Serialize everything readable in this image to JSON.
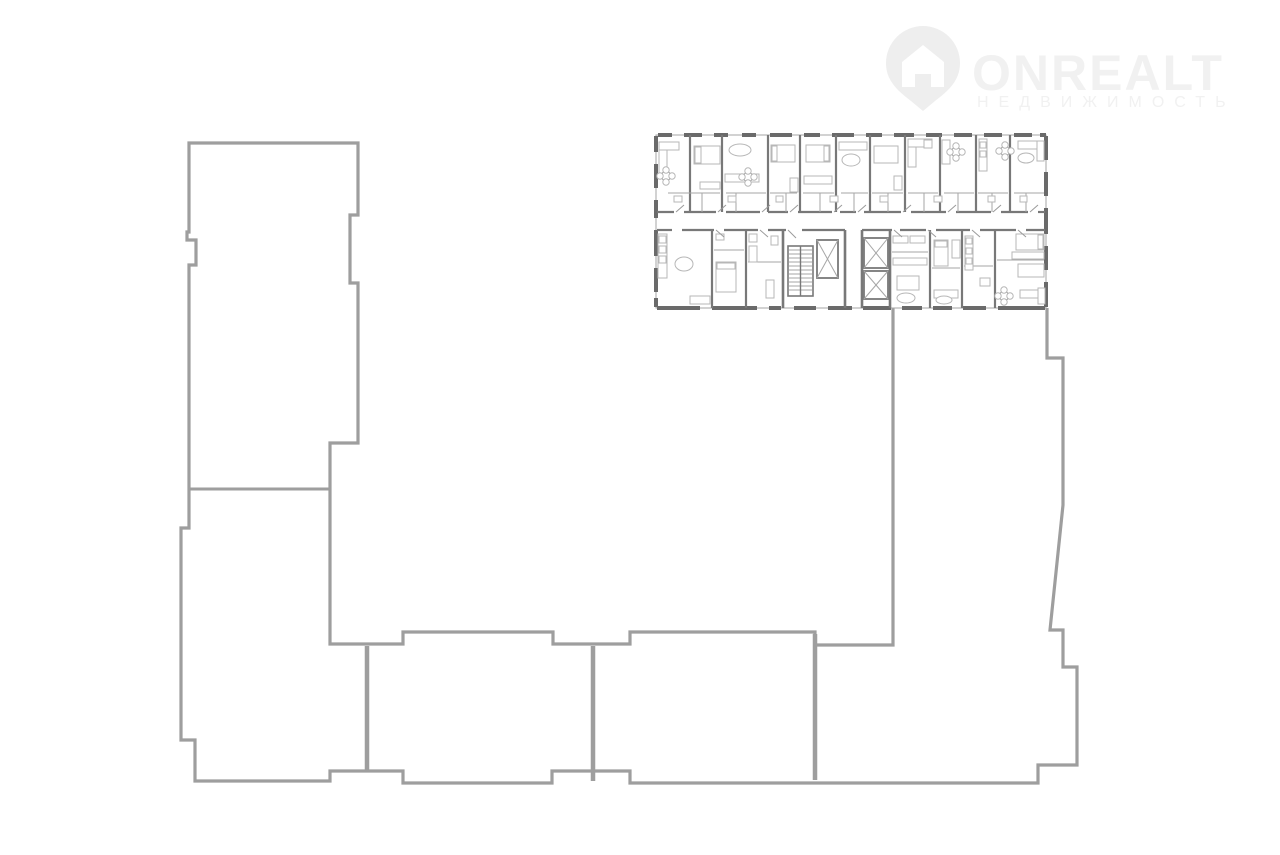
{
  "canvas": {
    "width": 1280,
    "height": 855,
    "background": "#ffffff"
  },
  "logo": {
    "brand": "ONREALT",
    "subtitle": "НЕДВИЖИМОСТЬ",
    "text_color": "#f1f1f1",
    "icon_color": "#eeeeee",
    "pin_path": "M 923,26 a 37,37 0 0 1 37,37 c 0,18 -12,28 -25,38 l -12,10 l -12,-10 c -13,-10 -25,-20 -25,-38 a 37,37 0 0 1 37,-37 z",
    "house_path": "M 923,45 l 21,17 v 25 h -13 v -13 h -16 v 13 h -13 v -25 z"
  },
  "building_outline": {
    "stroke": "#9e9e9e",
    "stroke_width": 3.2,
    "path": "M 893,308 L 893,645 L 815,645 L 815,632 L 630,632 L 630,644 L 553,644 L 553,632 L 403,632 L 403,644 L 330,644 L 330,443 L 358,443 L 358,283 L 350,283 L 350,215 L 358,215 L 358,143 L 189,143 L 189,232 L 187,232 L 187,240 L 196,240 L 196,265 L 189,265 L 189,528 L 181,528 L 181,740 L 195,740 L 195,781 L 330,781 L 330,771 L 403,771 L 403,783 L 552,783 L 552,771 L 630,771 L 630,783 L 1038,783 L 1038,765 L 1077,765 L 1077,667 L 1063,667 L 1063,630 L 1050,630 L 1063,505 L 1063,358 L 1047,358 L 1047,308",
    "dividers": [
      [
        367,
        646,
        367,
        770
      ],
      [
        593,
        646,
        593,
        781
      ],
      [
        815,
        634,
        815,
        780
      ]
    ],
    "divider_width": 4.5,
    "interior_lines": [
      [
        189,
        489,
        330,
        489
      ]
    ],
    "interior_width": 3
  },
  "floorplan": {
    "frame": {
      "x": 656,
      "y": 135,
      "w": 390,
      "h": 173
    },
    "colors": {
      "wall": "#787878",
      "pier": "#6a6a6a",
      "thin": "#a6a6a6",
      "furniture": "#b7b7b7",
      "door": "#9a9a9a"
    },
    "outer_piers_top": [
      [
        658,
        672
      ],
      [
        684,
        702
      ],
      [
        714,
        728
      ],
      [
        742,
        756
      ],
      [
        770,
        792
      ],
      [
        804,
        820
      ],
      [
        832,
        854
      ],
      [
        866,
        882
      ],
      [
        894,
        914
      ],
      [
        926,
        942
      ],
      [
        954,
        972
      ],
      [
        984,
        1002
      ],
      [
        1014,
        1032
      ],
      [
        1040,
        1046
      ]
    ],
    "outer_piers_bottom": [
      [
        657,
        700
      ],
      [
        712,
        757
      ],
      [
        769,
        781
      ],
      [
        794,
        816
      ],
      [
        828,
        852
      ],
      [
        863,
        891
      ],
      [
        902,
        922
      ],
      [
        933,
        952
      ],
      [
        963,
        986
      ],
      [
        998,
        1045
      ]
    ],
    "outer_piers_left": [
      [
        136,
        152
      ],
      [
        164,
        188
      ],
      [
        200,
        218
      ],
      [
        230,
        256
      ],
      [
        268,
        292
      ],
      [
        298,
        307
      ]
    ],
    "outer_piers_right": [
      [
        136,
        160
      ],
      [
        172,
        196
      ],
      [
        208,
        234
      ],
      [
        246,
        270
      ],
      [
        282,
        307
      ]
    ],
    "corridor_top_y": 212,
    "corridor_bottom_y": 230,
    "corridor_top_segments": [
      [
        657,
        674
      ],
      [
        684,
        716
      ],
      [
        726,
        760
      ],
      [
        768,
        788
      ],
      [
        798,
        832
      ],
      [
        840,
        856
      ],
      [
        864,
        901
      ],
      [
        911,
        946
      ],
      [
        956,
        991
      ],
      [
        1001,
        1028
      ],
      [
        1038,
        1045
      ]
    ],
    "corridor_bottom_segments": [
      [
        657,
        672
      ],
      [
        682,
        714
      ],
      [
        724,
        758
      ],
      [
        768,
        786
      ],
      [
        802,
        845
      ],
      [
        862,
        892
      ],
      [
        900,
        926
      ],
      [
        936,
        970
      ],
      [
        980,
        1016
      ],
      [
        1026,
        1045
      ]
    ],
    "vwalls_upper": [
      690,
      722,
      768,
      800,
      836,
      870,
      905,
      940,
      976,
      1010
    ],
    "vwalls_lower": [
      712,
      746,
      930,
      962,
      995
    ],
    "core_vwalls": [
      783,
      845,
      862,
      890
    ],
    "thin_walls": [
      [
        668,
        193,
        720,
        193
      ],
      [
        726,
        193,
        766,
        193
      ],
      [
        770,
        193,
        797,
        193
      ],
      [
        803,
        193,
        834,
        193
      ],
      [
        841,
        193,
        868,
        193
      ],
      [
        872,
        193,
        903,
        193
      ],
      [
        908,
        193,
        938,
        193
      ],
      [
        944,
        193,
        974,
        193
      ],
      [
        978,
        193,
        1008,
        193
      ],
      [
        1014,
        193,
        1044,
        193
      ],
      [
        702,
        193,
        702,
        212
      ],
      [
        736,
        193,
        736,
        212
      ],
      [
        786,
        193,
        786,
        212
      ],
      [
        820,
        193,
        820,
        212
      ],
      [
        854,
        193,
        854,
        212
      ],
      [
        888,
        193,
        888,
        212
      ],
      [
        924,
        193,
        924,
        212
      ],
      [
        958,
        193,
        958,
        212
      ],
      [
        992,
        193,
        992,
        212
      ],
      [
        1026,
        193,
        1026,
        212
      ],
      [
        714,
        250,
        744,
        250
      ],
      [
        748,
        262,
        781,
        262
      ],
      [
        892,
        252,
        928,
        252
      ],
      [
        932,
        268,
        960,
        268
      ],
      [
        964,
        266,
        993,
        266
      ],
      [
        997,
        260,
        1044,
        260
      ]
    ],
    "furniture_rects": [
      [
        659,
        142,
        8,
        34
      ],
      [
        659,
        142,
        20,
        8
      ],
      [
        694,
        146,
        26,
        18
      ],
      [
        695,
        147,
        6,
        16
      ],
      [
        700,
        182,
        20,
        7
      ],
      [
        725,
        174,
        34,
        8
      ],
      [
        771,
        145,
        24,
        17
      ],
      [
        772,
        146,
        5,
        15
      ],
      [
        790,
        178,
        8,
        14
      ],
      [
        806,
        145,
        24,
        17
      ],
      [
        824,
        146,
        5,
        15
      ],
      [
        804,
        176,
        28,
        8
      ],
      [
        839,
        142,
        28,
        8
      ],
      [
        874,
        146,
        24,
        17
      ],
      [
        894,
        176,
        8,
        14
      ],
      [
        908,
        139,
        8,
        28
      ],
      [
        908,
        139,
        24,
        8
      ],
      [
        924,
        140,
        8,
        8
      ],
      [
        942,
        140,
        8,
        24
      ],
      [
        979,
        139,
        8,
        32
      ],
      [
        980,
        142,
        6,
        6
      ],
      [
        980,
        151,
        6,
        6
      ],
      [
        1018,
        141,
        26,
        8
      ],
      [
        1037,
        141,
        7,
        20
      ],
      [
        674,
        196,
        8,
        6
      ],
      [
        728,
        196,
        8,
        6
      ],
      [
        776,
        196,
        7,
        6
      ],
      [
        830,
        196,
        8,
        6
      ],
      [
        880,
        196,
        8,
        6
      ],
      [
        934,
        196,
        8,
        6
      ],
      [
        988,
        196,
        7,
        6
      ],
      [
        1020,
        196,
        7,
        6
      ],
      [
        658,
        234,
        9,
        44
      ],
      [
        659,
        236,
        7,
        7
      ],
      [
        659,
        246,
        7,
        7
      ],
      [
        659,
        256,
        7,
        7
      ],
      [
        690,
        296,
        20,
        8
      ],
      [
        716,
        234,
        8,
        6
      ],
      [
        716,
        262,
        20,
        30
      ],
      [
        717,
        263,
        18,
        6
      ],
      [
        749,
        234,
        8,
        8
      ],
      [
        749,
        246,
        8,
        16
      ],
      [
        771,
        236,
        7,
        9
      ],
      [
        766,
        280,
        8,
        18
      ],
      [
        893,
        236,
        15,
        7
      ],
      [
        910,
        236,
        15,
        7
      ],
      [
        893,
        258,
        34,
        7
      ],
      [
        897,
        276,
        22,
        14
      ],
      [
        934,
        240,
        14,
        26
      ],
      [
        935,
        241,
        12,
        6
      ],
      [
        952,
        240,
        8,
        18
      ],
      [
        934,
        290,
        24,
        8
      ],
      [
        965,
        236,
        8,
        34
      ],
      [
        966,
        238,
        6,
        6
      ],
      [
        966,
        248,
        6,
        6
      ],
      [
        966,
        258,
        6,
        6
      ],
      [
        980,
        278,
        10,
        8
      ],
      [
        1016,
        234,
        28,
        16
      ],
      [
        1038,
        235,
        5,
        14
      ],
      [
        1012,
        252,
        32,
        7
      ],
      [
        1018,
        264,
        26,
        13
      ],
      [
        1020,
        290,
        24,
        8
      ],
      [
        1038,
        288,
        7,
        16
      ]
    ],
    "furniture_ellipses": [
      [
        740,
        150,
        11,
        6
      ],
      [
        851,
        160,
        9,
        6
      ],
      [
        1026,
        158,
        8,
        5
      ],
      [
        906,
        298,
        9,
        5
      ],
      [
        684,
        264,
        9,
        7
      ],
      [
        944,
        300,
        8,
        4
      ]
    ],
    "clover_tables": [
      [
        666,
        176
      ],
      [
        748,
        177
      ],
      [
        956,
        152
      ],
      [
        1005,
        151
      ],
      [
        1004,
        296
      ]
    ],
    "doors": [
      [
        676,
        212,
        684,
        205
      ],
      [
        718,
        212,
        726,
        205
      ],
      [
        762,
        212,
        770,
        205
      ],
      [
        790,
        212,
        798,
        205
      ],
      [
        834,
        212,
        842,
        205
      ],
      [
        858,
        212,
        866,
        205
      ],
      [
        903,
        212,
        911,
        205
      ],
      [
        948,
        212,
        956,
        205
      ],
      [
        993,
        212,
        1001,
        205
      ],
      [
        1030,
        212,
        1038,
        205
      ],
      [
        716,
        230,
        724,
        237
      ],
      [
        760,
        230,
        768,
        237
      ],
      [
        788,
        230,
        796,
        238
      ],
      [
        894,
        230,
        902,
        237
      ],
      [
        928,
        230,
        936,
        237
      ],
      [
        972,
        230,
        980,
        237
      ],
      [
        1018,
        230,
        1026,
        237
      ]
    ],
    "stairs": {
      "well": [
        788,
        246,
        25,
        50
      ],
      "tread_start": 250,
      "tread_end": 292,
      "tread_step": 4
    },
    "elevators": [
      [
        817,
        240,
        21,
        38
      ],
      [
        864,
        238,
        24,
        30
      ],
      [
        864,
        271,
        24,
        28
      ]
    ]
  }
}
